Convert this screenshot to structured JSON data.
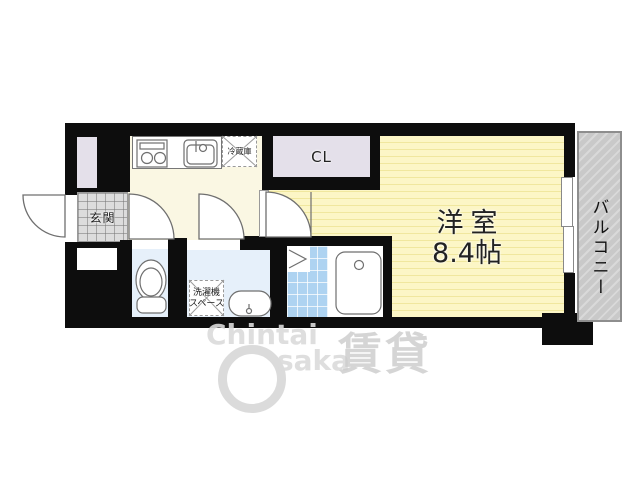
{
  "floorplan": {
    "labels": {
      "entrance": "玄関",
      "refrigerator": "冷蔵庫",
      "closet": "CL",
      "main_room_name": "洋室",
      "main_room_size": "8.4帖",
      "balcony": "バルコニー",
      "washer_space_line1": "洗濯機",
      "washer_space_line2": "スペース"
    },
    "watermark": {
      "line1": "Chintai",
      "line2": "saka",
      "brand_kanji": "賃貸"
    },
    "palette": {
      "wall": "#0d0d0d",
      "main_room_fill": "#fcf6c6",
      "main_room_stripe": "#f0e79e",
      "kitchen_fill": "#faf7e3",
      "closet_fill": "#e4e0ea",
      "entrance_fill": "#dcdcdc",
      "wet_room_fill": "#e6f0fa",
      "bath_tile_fill": "#aed3f1",
      "balcony_fill": "#c9c9c9",
      "fixture_stroke": "#6f6f6f",
      "watermark_color": "#d9d9d9"
    }
  }
}
